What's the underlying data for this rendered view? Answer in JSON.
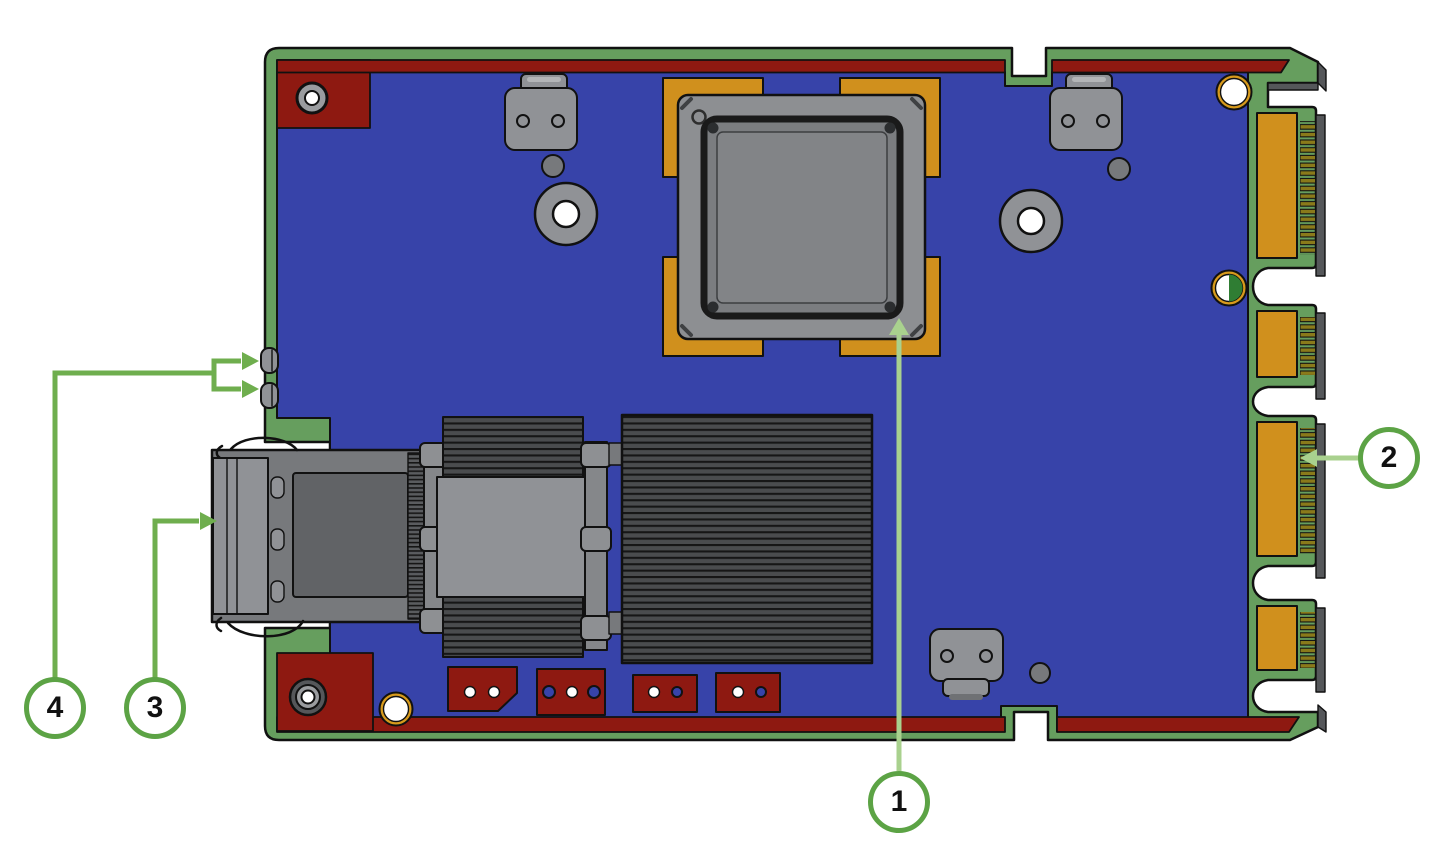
{
  "diagram": {
    "type": "pcb-adapter-card-callout-diagram",
    "callouts": [
      {
        "number": "1",
        "target": "bga-chip-package"
      },
      {
        "number": "2",
        "target": "gold-edge-connector-contacts"
      },
      {
        "number": "3",
        "target": "front-port-connector"
      },
      {
        "number": "4",
        "target": "side-retention-tabs"
      }
    ]
  },
  "colors": {
    "outline": "#111111",
    "pcb_green": "#669e5e",
    "pcb_blue": "#3743a9",
    "copper_red": "#8e1911",
    "pad_gold": "#d0901d",
    "contact_olive": "#8a7a1a",
    "ring_orange": "#d79a1c",
    "key_green": "#2f7d33",
    "gray_light": "#909296",
    "gray_mid": "#77797c",
    "gray_dark": "#55575a",
    "fin_bg": "#4a4c4e",
    "fin_line": "#161616",
    "callout_ring": "#5ca345",
    "callout_line_light": "#a9d18e",
    "callout_line_dark": "#6fae4e",
    "callout_text": "#111111"
  }
}
